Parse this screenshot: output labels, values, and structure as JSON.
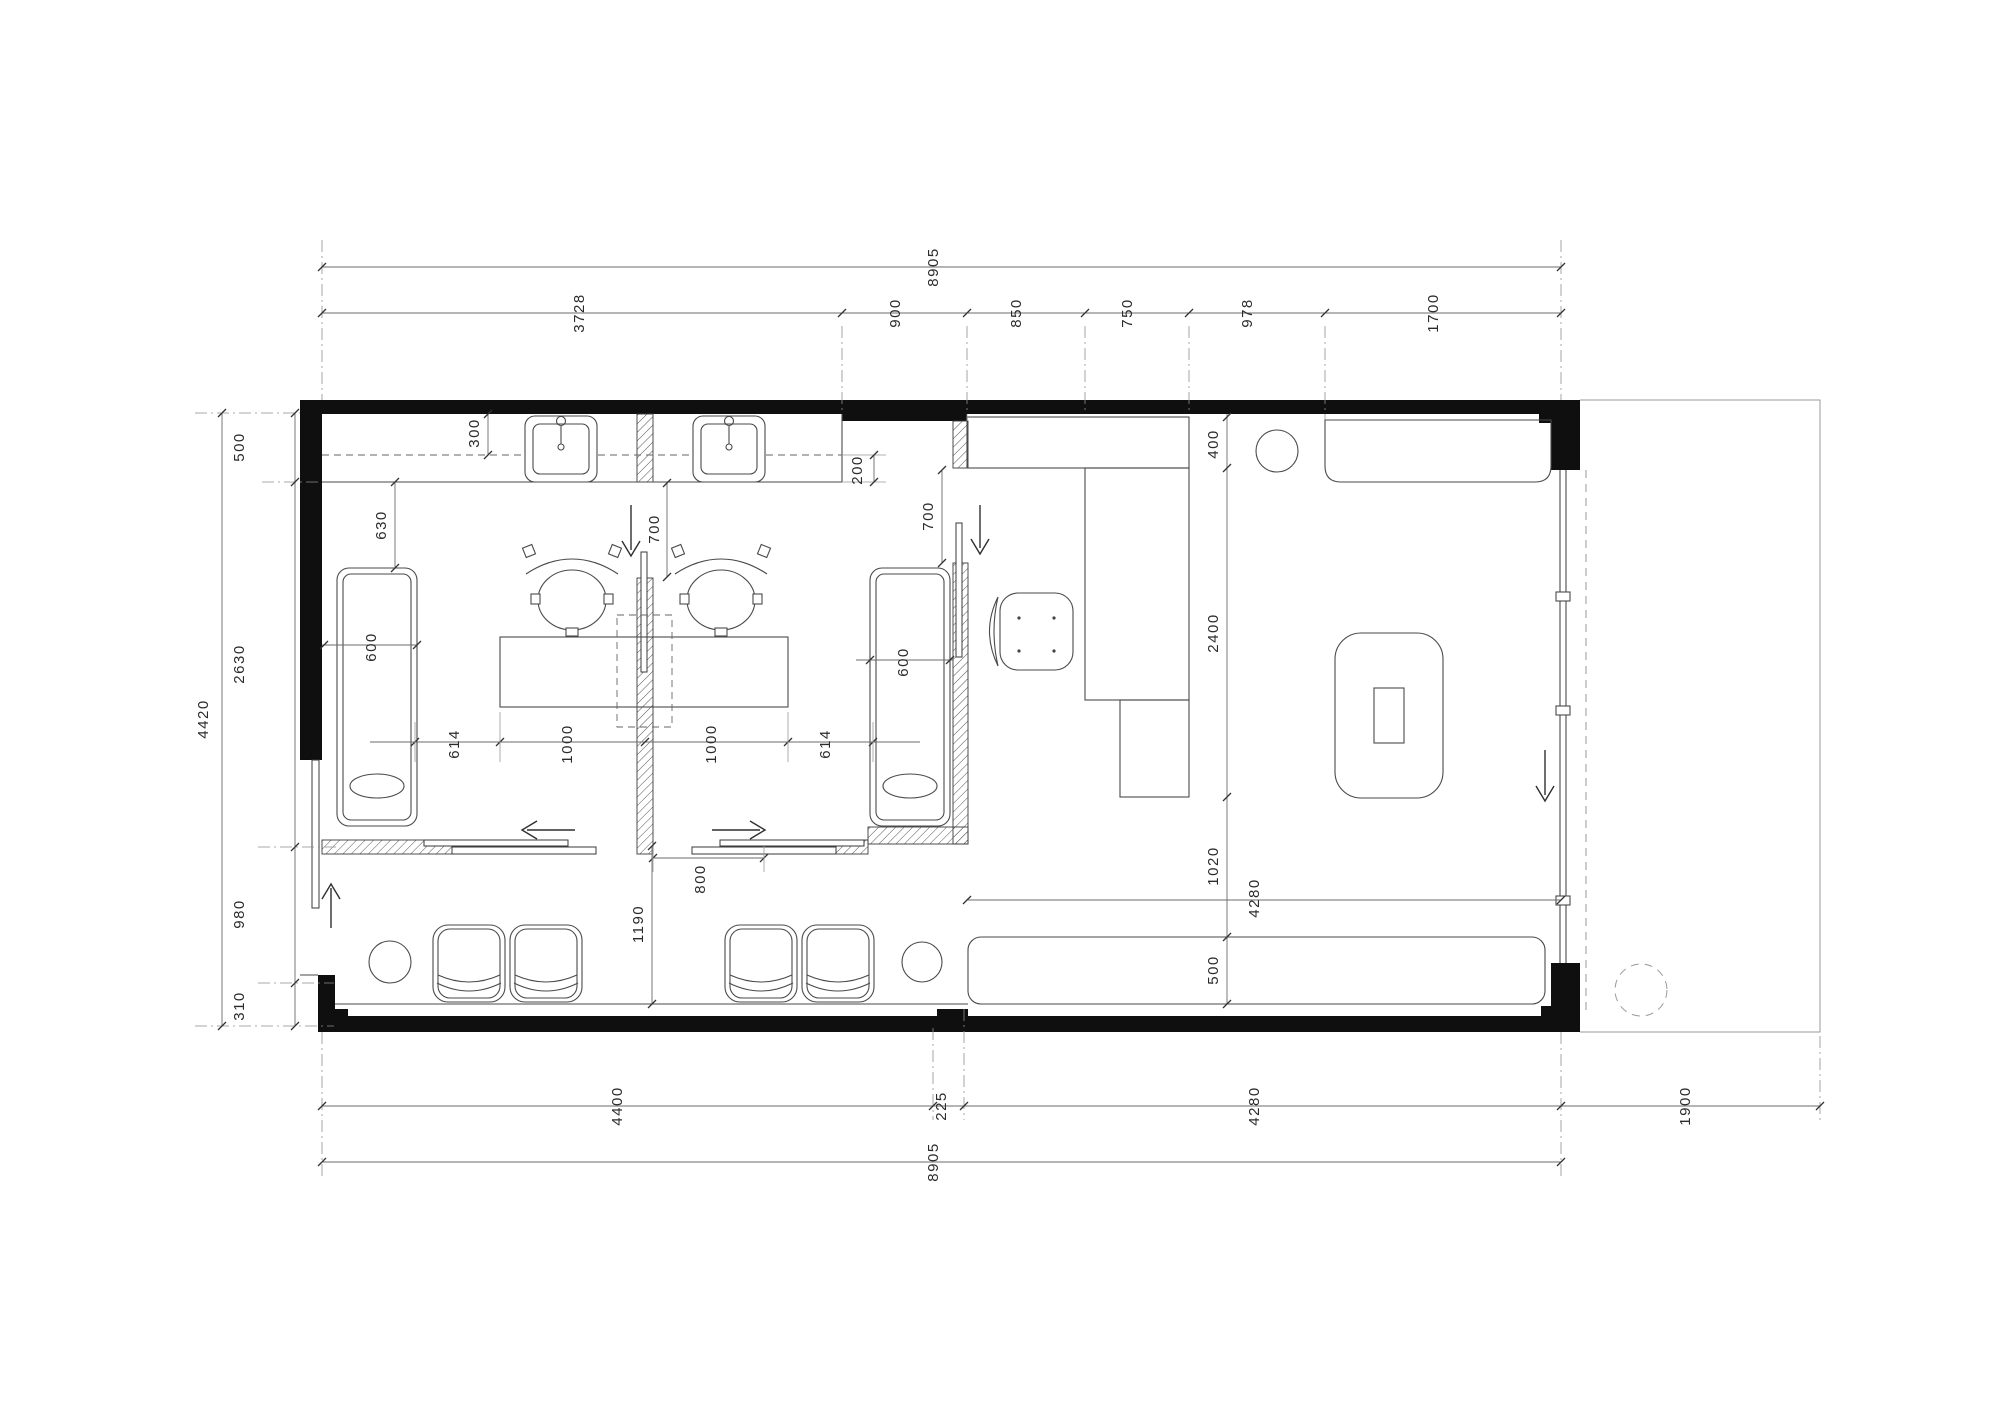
{
  "dims": {
    "top_overall": "8905",
    "top_segs": [
      "3728",
      "900",
      "850",
      "750",
      "978",
      "1700"
    ],
    "bottom_segs": [
      "4400",
      "225",
      "4280"
    ],
    "bottom_overall": "8905",
    "terrace_1900": "1900",
    "left_overall": "4420",
    "left_segs": [
      "500",
      "2630",
      "980",
      "310"
    ],
    "counter_300": "300",
    "counter_200": "200",
    "gap_630": "630",
    "couch_left_600": "600",
    "couch_right_600": "600",
    "door_left_700": "700",
    "door_right_700": "700",
    "row_614_left": "614",
    "row_1000_left": "1000",
    "row_1000_right": "1000",
    "row_614_right": "614",
    "door_800": "800",
    "clear_1190": "1190",
    "closet_400": "400",
    "desk_2400": "2400",
    "desk_bench_1020": "1020",
    "bench_4280": "4280",
    "bench_500": "500"
  }
}
